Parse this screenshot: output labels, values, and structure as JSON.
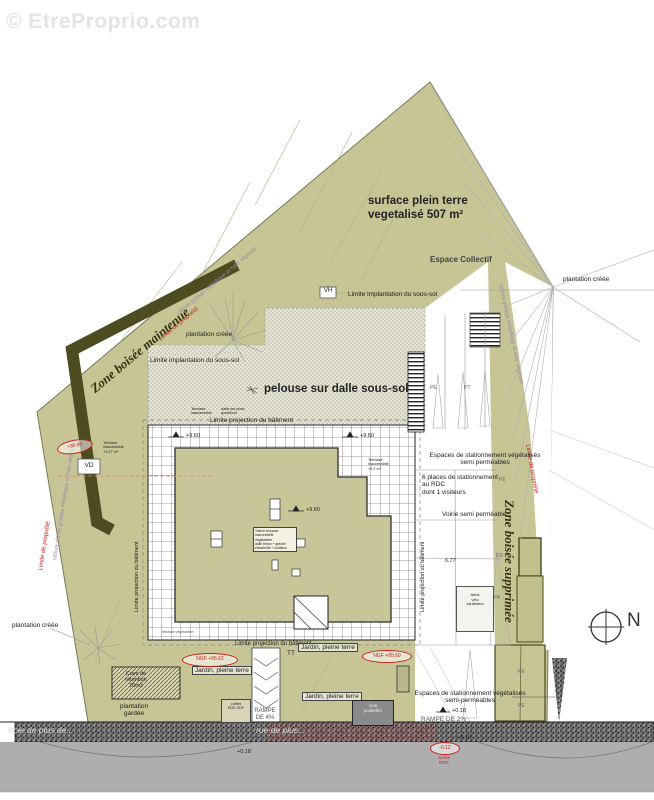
{
  "watermark": {
    "text": "© EtreProprio.com"
  },
  "plan": {
    "title": {
      "line1": "surface plein terre",
      "line2": "vegetalisé 507 m²"
    },
    "areas": {
      "espace_collectif": "Espace Collectif",
      "pelouse": "pelouse sur dalle sous-sol",
      "zone_boisee_maintenue": "Zone boisée maintenue",
      "zone_boisee_supprimee": "Zone boisée supprimée"
    },
    "limits": {
      "implantation_sous_sol_top": "Limite implantation du sous-sol",
      "implantation_sous_sol_left": "Limite implantation du sous-sol",
      "projection_batiment_top": "Limite projection du bâtiment",
      "projection_batiment_bottom": "Limite projection du bâtiment",
      "projection_batiment_left": "Limite projection du bâtiment",
      "projection_batiment_right": "Limite projection du bâtiment",
      "propriete_upper_left": "Limite de propriété",
      "propriete_lower_left": "Limite de propriété",
      "propriete_right": "Limite de propriété",
      "cloture_upper_left": "clôture grillage métallique et haie végétale",
      "cloture_lower_left": "clôture d'1.80 grillage métallique et haie végétale",
      "cloture_right": "clôture grillage métallique et haie végétale"
    },
    "plantations": {
      "creee_left": "plantation créée",
      "creee_right": "plantation créée",
      "creee_bottom": "plantation créée",
      "gardee": "plantation\ngardée"
    },
    "parking": {
      "espaces_top": "Espaces de stationnement végétalisés\nsemi perméables",
      "places": "6 places de stationnement\nau RDC\ndont 1 visiteurs",
      "voirie": "Voirie semi perméable",
      "espaces_bottom": "Espaces de stationnement végétalisés\nsemi-perméables",
      "pe_top": "PE",
      "pt_top": "PT",
      "pe_mid": "PE",
      "ds": "DS",
      "pa": "PA",
      "pe_b1": "PE",
      "pe_b2": "PE"
    },
    "garden": {
      "jardin1": "Jardin, pleine terre",
      "jardin2": "Jardin, pleine terre",
      "jardin3": "Jardin, pleine terre",
      "cuve": "Cuve de\nrétention\n20m3",
      "tt": "TT",
      "terrasse_note": "terrasse végétalisée"
    },
    "ramps": {
      "rampe4": "RAMPE\nDE 4%",
      "rampe2": "RAMPE DE 2%"
    },
    "boxes": {
      "vh": "VH",
      "vd": "VD",
      "abris": "Abris\nvélo\nJardinière",
      "roof_note": "Toiture terrasse inaccessible\nvégétalisée\ndalle béton + gravier\nétanchéité + isolation",
      "terrasse_left": "Terrasse\ninaccessible\n+9.27 m²",
      "terrasse_top": "Terrasse\ninaccessible",
      "terrasse_top2": "dalle sur plots\ngravillons",
      "terrasse_right": "Terrasse\ninaccessible\n+9.2 m²",
      "coffret": "coffret\nEDF-GDF",
      "local": "local\npoubelles"
    },
    "levels": {
      "l1": "+9.60",
      "l2": "+9.60",
      "l3": "+9.60",
      "d677": "6.77",
      "p018a": "+0.18",
      "p018b": "+0.18",
      "p018c": "+0.18"
    },
    "red_marks": {
      "r1": "+95.65",
      "r2": "NGF +95.63",
      "r3": "NGF +95.60",
      "r4": "-0.12",
      "r4b": "accès\nRDC"
    },
    "streets": {
      "left": "Voie de plus de...",
      "right": "rue de plus..."
    },
    "compass": "N"
  },
  "colors": {
    "site_green": "#c7c595",
    "dark_wood_band": "#4c4c20",
    "stipple_bg": "#e6e5d6",
    "road": "#aeaeae",
    "sidewalk": "#7c7c7c",
    "annotation_red": "#c42222",
    "fence_violet": "#9b8aa8"
  }
}
